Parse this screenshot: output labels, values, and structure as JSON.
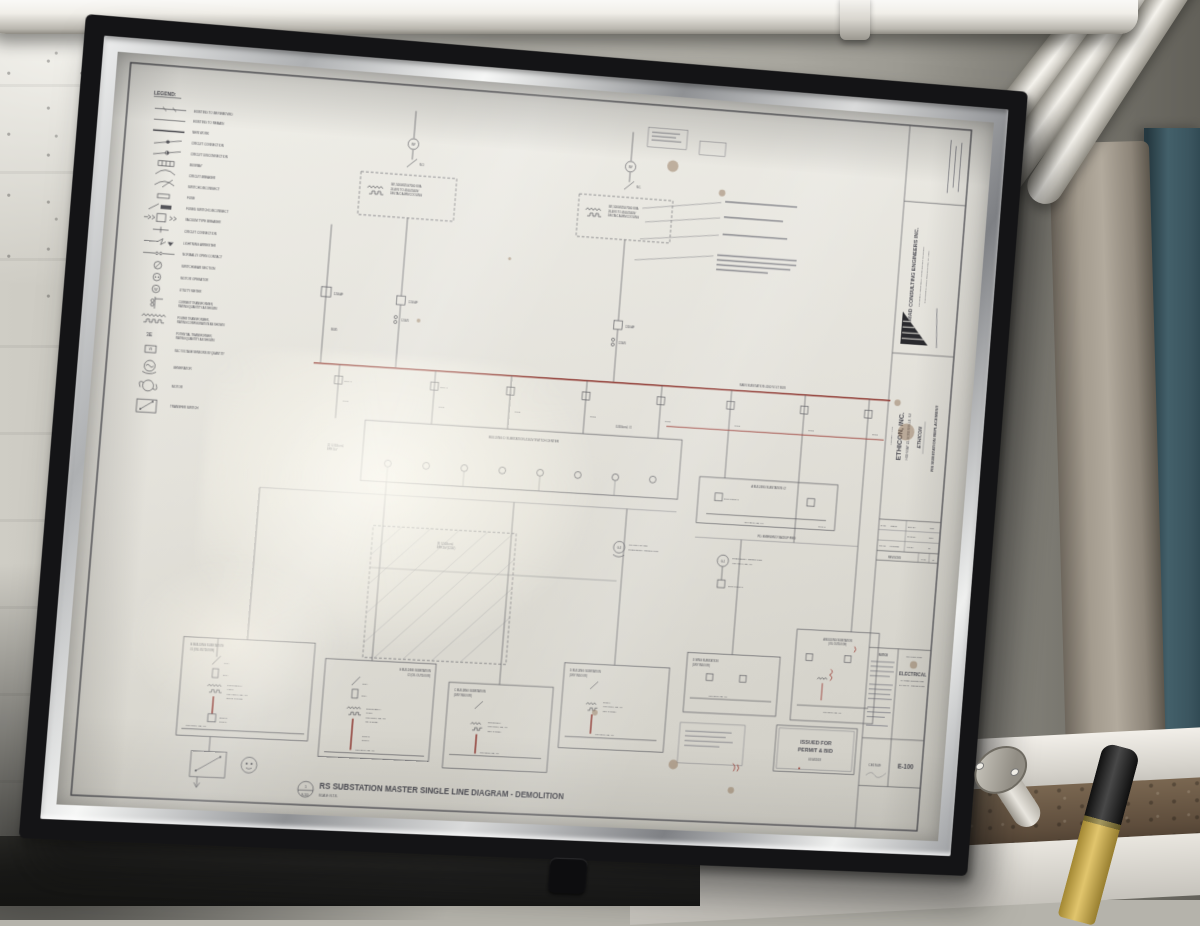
{
  "sheet": {
    "legend": {
      "title": "LEGEND:",
      "items": [
        {
          "l1": "EXISTING TO BE REMOVED",
          "l2": ""
        },
        {
          "l1": "EXISTING TO REMAIN",
          "l2": ""
        },
        {
          "l1": "NEW WORK",
          "l2": ""
        },
        {
          "l1": "CIRCUIT CONNECTION",
          "l2": ""
        },
        {
          "l1": "CIRCUIT DISCONNECTION",
          "l2": ""
        },
        {
          "l1": "BUSWAY",
          "l2": ""
        },
        {
          "l1": "CIRCUIT BREAKER",
          "l2": ""
        },
        {
          "l1": "SWITCH DISCONNECT",
          "l2": ""
        },
        {
          "l1": "FUSE",
          "l2": ""
        },
        {
          "l1": "FUSED SWITCH DISCONNECT",
          "l2": ""
        },
        {
          "l1": "VACUUM TYPE BREAKER",
          "l2": ""
        },
        {
          "l1": "CIRCUIT CONNECTION",
          "l2": ""
        },
        {
          "l1": "LIGHTNING ARRESTER",
          "l2": ""
        },
        {
          "l1": "NORMALLY OPEN CONTACT",
          "l2": ""
        },
        {
          "l1": "SWITCHGEAR SECTION",
          "l2": ""
        },
        {
          "l1": "MOTOR OPERATOR",
          "l2": ""
        },
        {
          "l1": "UTILITY METER",
          "l2": ""
        },
        {
          "l1": "CURRENT TRANSFORMER,",
          "l2": "RATING/QUANTITY AS SHOWN"
        },
        {
          "l1": "POWER TRANSFORMER,",
          "l2": "RATING/CONFIGURATION AS SHOWN"
        },
        {
          "l1": "POTENTIAL TRANSFORMER,",
          "l2": "RATING/QUANTITY AS SHOWN"
        },
        {
          "l1": "S&C VOLTAGE SENSORS W/ QUANTITY",
          "l2": ""
        },
        {
          "l1": "GENERATOR",
          "l2": ""
        },
        {
          "l1": "MOTOR",
          "l2": ""
        },
        {
          "l1": "TRANSFER SWITCH",
          "l2": ""
        }
      ],
      "glyphs": {
        "meter": "W",
        "pt": "3E",
        "vs": "VS"
      }
    },
    "titleblock": {
      "firm_name": "TRIAD CONSULTING ENGINEERS INC.",
      "firm_tagline": "ENGINEERS - DESIGNERS - CONSTRUCTION MANAGERS",
      "firm_address": "2740 ROUTE 10 WEST, MORRIS PLAINS, N.J. 07950",
      "project_title_label": "PROJECT TITLE",
      "client": "ETHICON, INC.",
      "client_address": "HIGHWAY 22, SOMERVILLE, NJ",
      "client_logo": "ETHICON",
      "project": "RS SUBSTATION REPLACEMENT",
      "date_label": "DATE",
      "date": "8/22/17",
      "drw_label": "DRW BY",
      "drw": "MTB",
      "chkd_label": "CHKD BY",
      "chkd": "NCC",
      "scale_label": "SCALE",
      "scale": "AS NOTED",
      "app_label": "APP BY",
      "app": "RL",
      "revisions_label": "REVISIONS",
      "rev_date_label": "DATE",
      "rev_by_label": "BY",
      "notice_label": "NOTICE",
      "drawing_title_label": "DRAWING TITLE",
      "dt1": "ELECTRICAL",
      "dt2": "MASTER SINGLE LINE",
      "dt3": "DIAGRAM - DEMOLITION",
      "job_no": "CE17049",
      "sheet_no": "E-100",
      "issued1": "ISSUED FOR",
      "issued2": "PERMIT & BID",
      "issued_date": "01/04/2018"
    },
    "footer": {
      "title": "RS SUBSTATION MASTER SINGLE LINE DIAGRAM - DEMOLITION",
      "scale": "SCALE: N.T.S.",
      "detail_no": "1",
      "detail_sheet": "E-100"
    },
    "schematic": {
      "main_bus": "MAIN SUBSTATION 4160 VOLT BUS",
      "switch_center": "BUILDING D SUBSTATION 4160V SWITCH CENTER",
      "tx_main_l1": "3Ø, 5000/6250/7000 KVA",
      "tx_main_l2": "26.4KV TO 4160/2400V",
      "tx_main_l3": "DELTA C ALRM COOLING",
      "no_label": "N.O.",
      "nc_label": "N.C.",
      "bkr_1200af": "1200 AF",
      "ct_1200_5": "1200/5",
      "ct_600_5": "600/5",
      "ct_800_5": "800/5",
      "cable_a1": "(2) 3-350kcmil,",
      "cable_a2": "EPR 5kV",
      "cable_b": "3-350kcmil, #1",
      "cable_c1": "(3) 3-500kcmil,",
      "cable_c2": "EPR 5kV (1200')",
      "pd_feed": "P.D. EMERGENCY BACKUP FEED",
      "gen1_tag": "G-1",
      "gen1_l1": "EMERGENCY GENERATOR",
      "gen1_l2": "480Y/277V, 3Ø, 4W",
      "gen2_tag": "G-3",
      "gen2_l1": "GLYCOL HEATER",
      "gen2_l2": "EMERGENCY GENERATOR",
      "g1_name": "G BUILDING SUBSTATION",
      "g1_name2": "#1 (OIL OUTDOOR)",
      "g1_sw": "600A",
      "g1_fuse": "200A",
      "g1_tx1": "1000/1150kVA",
      "g1_tx2": "4160V",
      "g1_tx3": "480Y/277V, 3Ø, 4W",
      "g1_tx4": "(55/65°C RISE)",
      "g1_bkr1": "2000AS",
      "g1_bkr2": "1600AT",
      "g1_bus": "480Y/277V, 3Ø, 4W",
      "g2_name": "G BUILDING SUBSTATION",
      "g2_name2": "#2 (OIL OUTDOOR)",
      "g2_sw": "600A",
      "g2_fuse": "300A",
      "g2_tx1": "1500/1725kVA",
      "g2_tx2": "4160V",
      "g2_tx3": "480Y/277V, 3Ø, 4W",
      "g2_tx4": "(65°C RISE)",
      "g2_bkr1": "3000AS",
      "g2_bkr2": "3000AT",
      "g2_bus": "480Y/277V, 3Ø, 4W",
      "c_name": "C BUILDING SUBSTATION",
      "c_name2": "(DRY INDOOR)",
      "c_tx1": "750/1000kVA",
      "c_tx2": "480Y/277V, 3Ø, 4W",
      "c_tx3": "(150°C RISE)",
      "c_bus": "480Y/277V, 3Ø, 4W",
      "dm_name": "D BUILDING SUBSTATION",
      "dm_name2": "(DRY INDOOR)",
      "dm_tx1": "500kVA",
      "dm_tx2": "480Y/277V, 3Ø, 4W",
      "dm_tx3": "(150°C RISE)",
      "dm_bus": "480Y/277V, 3Ø, 4W",
      "dw_name": "D WING SUBSTATION",
      "dw_name2": "(DRY INDOOR)",
      "dw_bus": "480Y/277V, 3Ø, 4W",
      "a2_name": "A BUILDING SUBSTATION #2",
      "a2_bus": "480Y/277V, 3Ø, 4W",
      "a2_tag": "SWG-2",
      "a2_bkr": "2000AS/2000AT",
      "a1_name": "A BUILDING SUBSTATION",
      "a1_name2": "(OIL OUTDOOR)",
      "a1_bus": "480Y/277V, 3Ø, 4W",
      "meter_glyph": "W"
    }
  },
  "colors": {
    "bus_red": "#8d352e",
    "paper": "#eceae3",
    "frame_black": "#141416",
    "cabinet_teal": "#43606a",
    "handle_yellow": "#d9b544"
  }
}
